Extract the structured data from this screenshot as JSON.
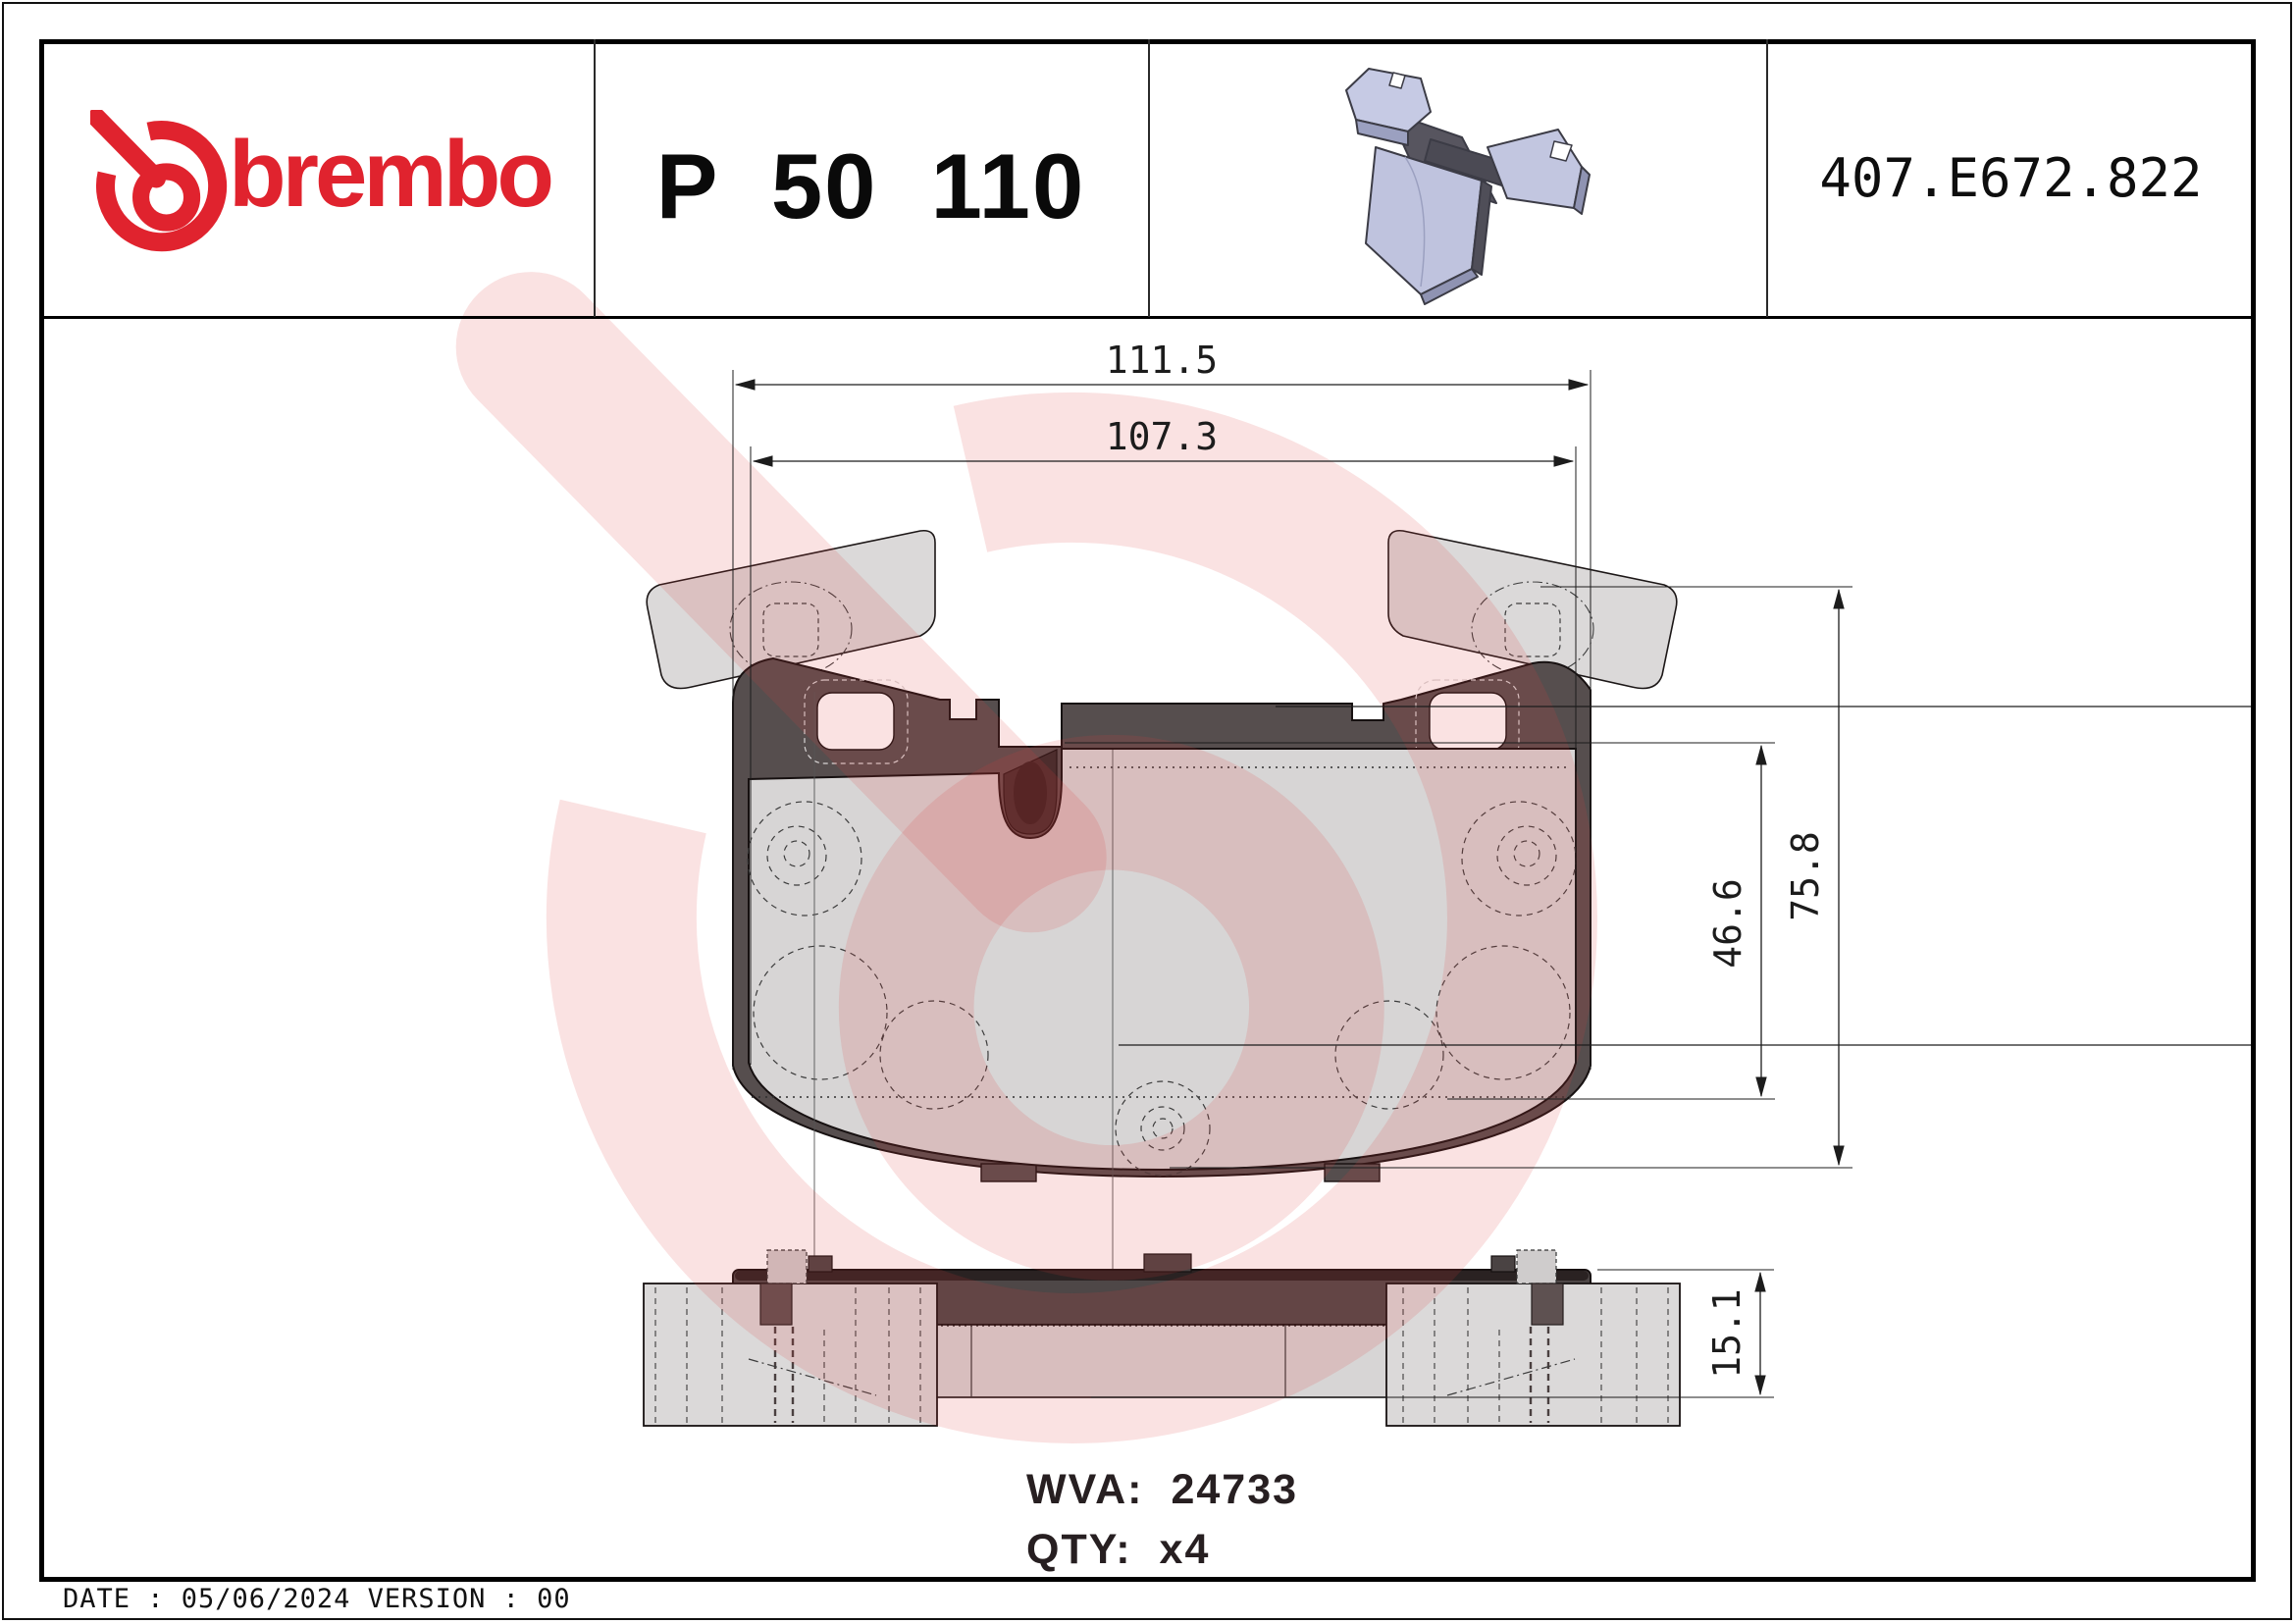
{
  "header": {
    "brand": "brembo",
    "part_number": "P 50 110",
    "catalog_code": "407.E672.822"
  },
  "dimensions": {
    "overall_width": "111.5",
    "pad_width": "107.3",
    "overall_height": "75.8",
    "friction_height": "46.6",
    "thickness": "15.1"
  },
  "info": {
    "wva_label": "WVA:",
    "wva_value": "24733",
    "qty_label": "QTY:",
    "qty_value": "x4"
  },
  "footer": {
    "text": "DATE : 05/06/2024 VERSION : 00"
  },
  "icons": {
    "logo": "brembo-logo-icon",
    "watermark": "brembo-watermark-icon",
    "product_render": "brake-pad-3d-icon"
  },
  "colors": {
    "brand_red": "#e0232e",
    "watermark_pink": "#f7dddd",
    "backplate_dark": "#564e4e",
    "pad_gray": "#d7d5d5",
    "render_lavender": "#bfc3de"
  }
}
